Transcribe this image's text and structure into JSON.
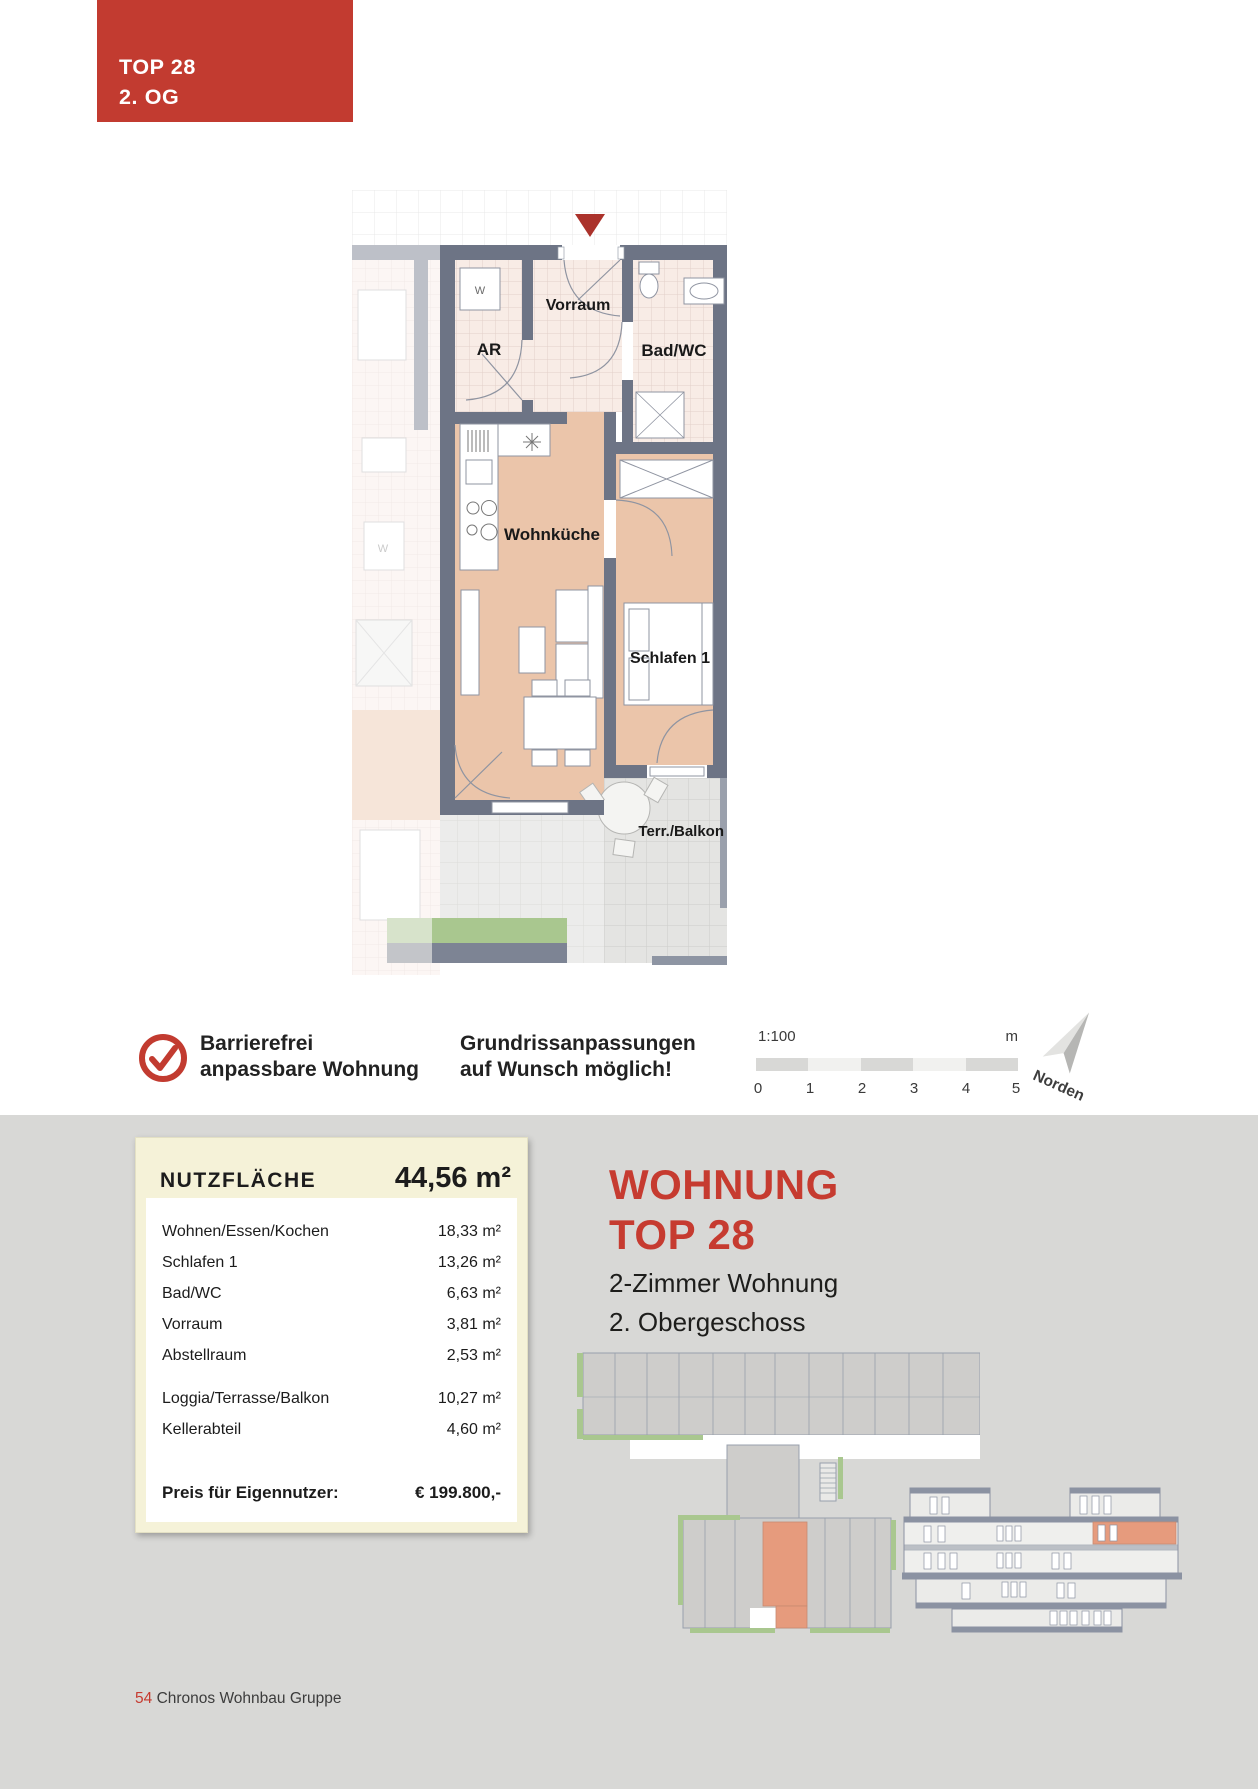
{
  "header_tag": {
    "line1": "TOP 28",
    "line2": "2. OG"
  },
  "floorplan": {
    "rooms": {
      "vorraum": "Vorraum",
      "abstellraum": "AR",
      "bad": "Bad/WC",
      "wohnkueche": "Wohnküche",
      "schlafen": "Schlafen 1",
      "terrasse": "Terr./Balkon"
    },
    "washer_label": "W"
  },
  "badges": {
    "barrier_free_line1": "Barrierefrei",
    "barrier_free_line2": "anpassbare Wohnung",
    "adapt_line1": "Grundrissanpassungen",
    "adapt_line2": "auf Wunsch möglich!"
  },
  "scalebar": {
    "ratio": "1:100",
    "unit": "m",
    "ticks": [
      "0",
      "1",
      "2",
      "3",
      "4",
      "5"
    ]
  },
  "compass": {
    "label": "Norden"
  },
  "area_table": {
    "title": "NUTZFLÄCHE",
    "total": "44,56 m²",
    "rows": [
      {
        "label": "Wohnen/Essen/Kochen",
        "value": "18,33 m²"
      },
      {
        "label": "Schlafen 1",
        "value": "13,26 m²"
      },
      {
        "label": "Bad/WC",
        "value": "6,63 m²"
      },
      {
        "label": "Vorraum",
        "value": "3,81 m²"
      },
      {
        "label": "Abstellraum",
        "value": "2,53 m²"
      },
      {
        "label": "Loggia/Terrasse/Balkon",
        "value": "10,27 m²"
      },
      {
        "label": "Kellerabteil",
        "value": "4,60 m²"
      }
    ],
    "price_label": "Preis für Eigennutzer:",
    "price_value": "€ 199.800,-"
  },
  "unit_info": {
    "title_line1": "WOHNUNG",
    "title_line2": "TOP 28",
    "subtitle_line1": "2-Zimmer Wohnung",
    "subtitle_line2": "2. Obergeschoss"
  },
  "footer": {
    "page_number": "54",
    "company": "Chronos Wohnbau Gruppe"
  },
  "colors": {
    "accent_red": "#c63b30",
    "marker_red": "#ab322b",
    "wall_gray": "#6d7485",
    "floor_salmon": "#ebc5aa",
    "tile_pink": "#f8ece6",
    "terrace_gray": "#e4e4e2",
    "planter_green": "#a9c78f",
    "highlight_salmon": "#e69b7d"
  }
}
